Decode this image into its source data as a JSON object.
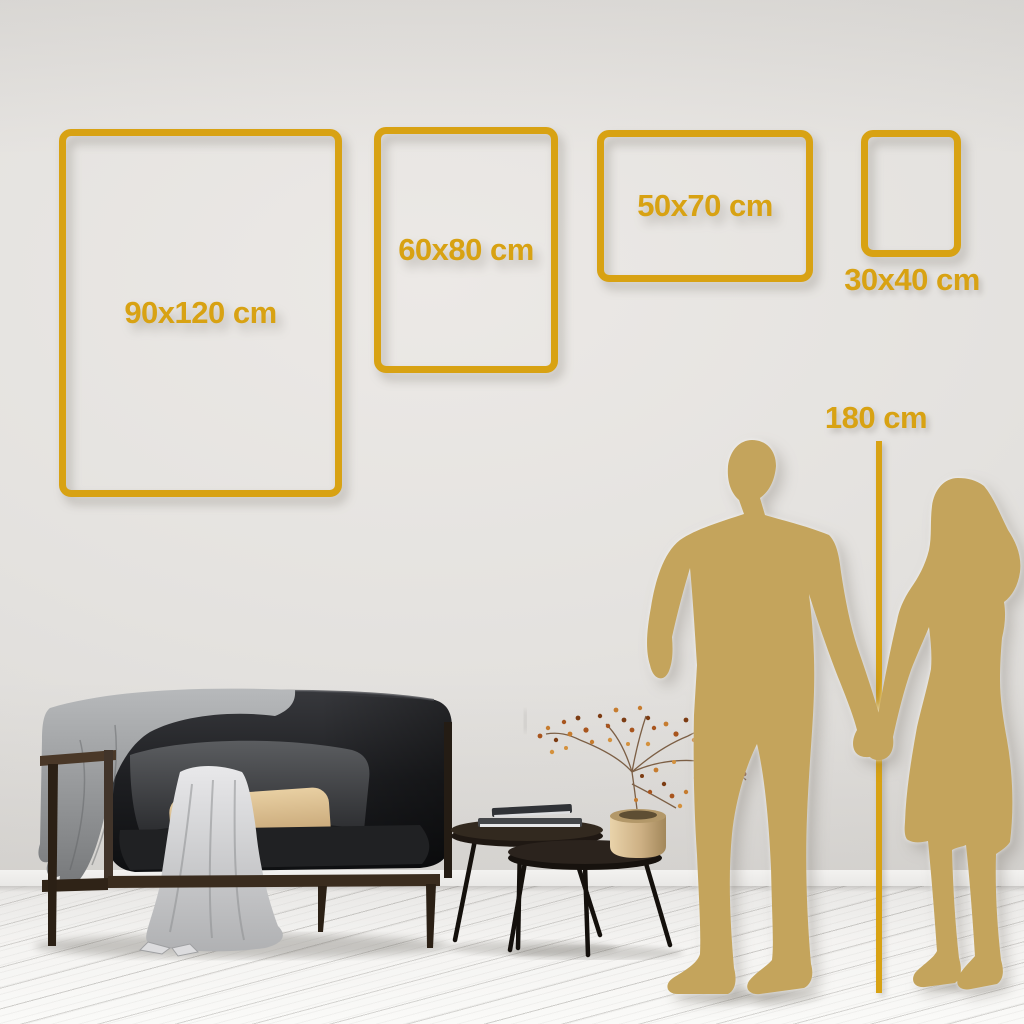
{
  "frames": [
    {
      "id": "90x120",
      "label": "90x120 cm"
    },
    {
      "id": "60x80",
      "label": "60x80 cm"
    },
    {
      "id": "50x70",
      "label": "50x70 cm"
    },
    {
      "id": "30x40",
      "label": "30x40 cm"
    }
  ],
  "height_marker": {
    "label": "180 cm"
  },
  "colors": {
    "accent_gold": "#D8A213",
    "silhouette_gold": "#C4A45C",
    "wall": "#E4E2DF",
    "floor": "#F2F1EF"
  }
}
